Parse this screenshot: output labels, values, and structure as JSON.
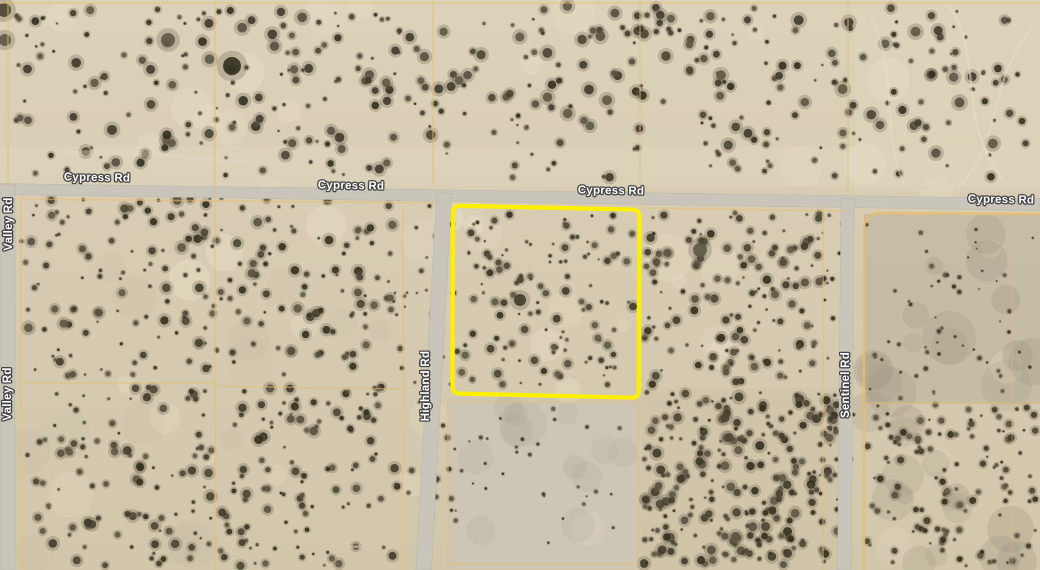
{
  "roads": {
    "cypress": {
      "name": "Cypress Rd"
    },
    "valley": {
      "name": "Valley Rd"
    },
    "highland": {
      "name": "Highland Rd"
    },
    "sentinel": {
      "name": "Sentinel Rd"
    }
  },
  "parcel": {
    "outline_color": "#fcef02"
  },
  "colors": {
    "terrain_base": "#d8cdb4",
    "road_fill": "#c9c5ba",
    "road_edge": "#b2ad9e",
    "cadastral_line": "#e9bd6e",
    "label_text": "#fdfdfd"
  }
}
